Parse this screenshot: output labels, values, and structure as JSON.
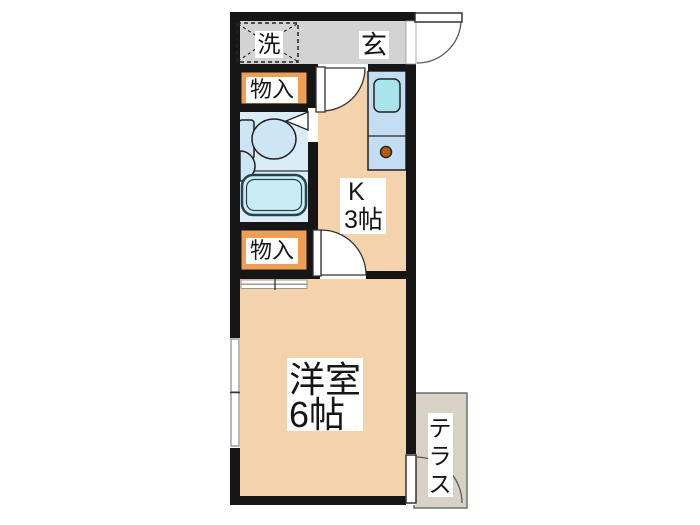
{
  "floorplan": {
    "labels": {
      "laundry": "洗",
      "entrance": "玄",
      "storage_upper": "物入",
      "storage_lower": "物入",
      "kitchen_name": "K",
      "kitchen_size": "3帖",
      "room_name": "洋室",
      "room_size": "6帖",
      "terrace": "テラス",
      "terrace_chars": [
        "テ",
        "ラ",
        "ス"
      ]
    },
    "colors": {
      "wall": "#161616",
      "room_fill": "#f4d3ac",
      "storage_fill": "#f09d55",
      "entrance_fill": "#d3d3d3",
      "bathroom_fill": "#d9ecf8",
      "terrace_fill": "#d8d1c5",
      "fixture_fill": "#cde6f5",
      "tub_fill": "#c9edf3",
      "counter_fill": "#c3def2",
      "sink_fill": "#a9e4ec",
      "burner": "#b35b11"
    }
  }
}
